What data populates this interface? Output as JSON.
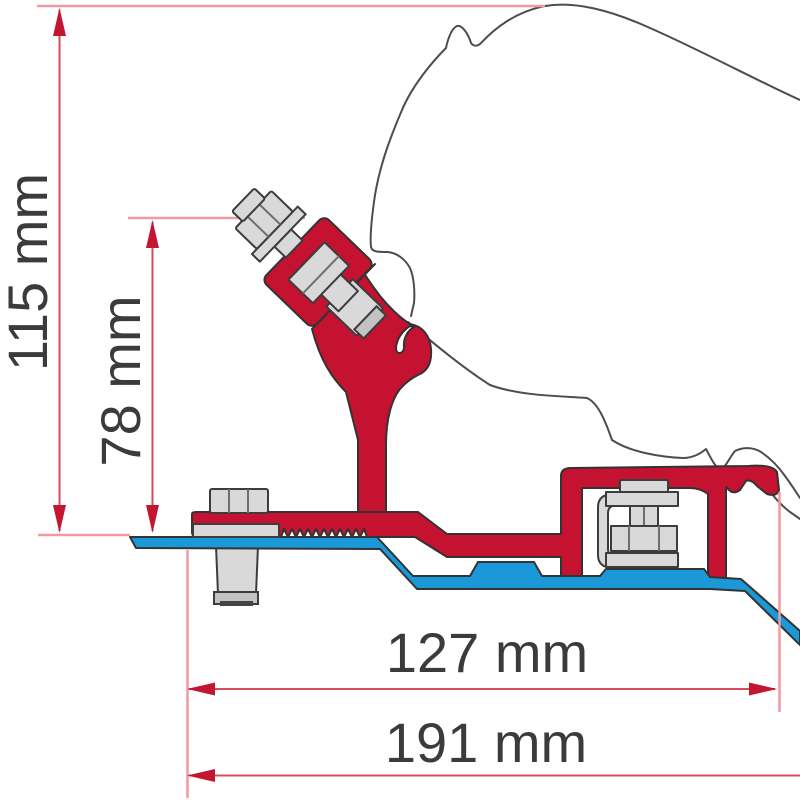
{
  "diagram": {
    "title": "awning-roof-bracket-cross-section",
    "description": "Technical cross-section of an awning adapter bracket (red profile) on a roof plate (blue) with mounting bolts and overall dimensions",
    "dimensions": [
      {
        "id": "total-height",
        "label": "115 mm",
        "orientation": "vertical"
      },
      {
        "id": "bracket-height",
        "label": "78 mm",
        "orientation": "vertical"
      },
      {
        "id": "inner-width",
        "label": "127 mm",
        "orientation": "horizontal"
      },
      {
        "id": "total-width",
        "label": "191 mm",
        "orientation": "horizontal"
      }
    ],
    "colors": {
      "bracket_red": "#c41230",
      "plate_blue": "#1b98d8",
      "hardware_gray": "#d9d9d9",
      "part_outline": "#333333",
      "vehicle_outline": "#4d4d4d",
      "dimension_line": "#d84b5a",
      "extension_line": "#f09aa4",
      "arrow": "#c21631",
      "label_text": "#3b3b3b",
      "background": "#ffffff"
    }
  }
}
